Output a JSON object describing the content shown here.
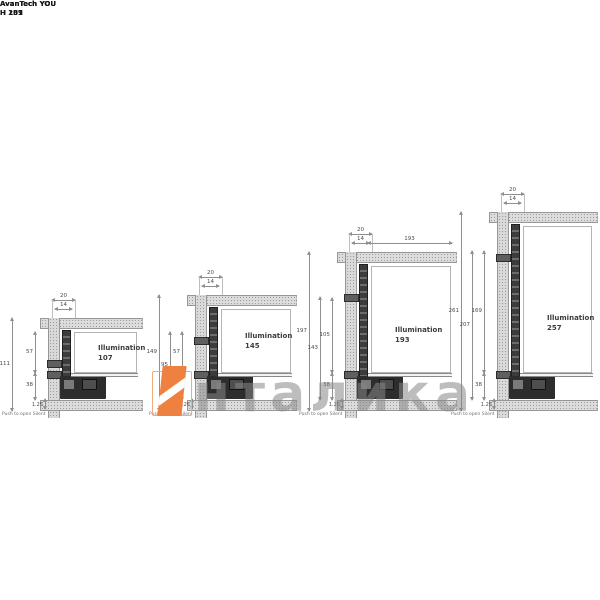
{
  "watermark": {
    "text": "нталика",
    "logo_color": "#ee8140",
    "outline_color": "#f3aa7c",
    "text_color": "#878787"
  },
  "drawings": [
    {
      "title_line1": "AvanTech YOU",
      "title_line2": "H 101",
      "illumination_label": "Illumination",
      "illumination_value": "107",
      "dim_width_outer": "20",
      "dim_width_inner": "14",
      "dim_total": "111",
      "dim_outer": "",
      "dim_upper": "57",
      "dim_lower": "38",
      "dim_top_right": "",
      "bottom_gap": "1.25",
      "note": "Push to open Silent"
    },
    {
      "title_line1": "AvanTech YOU",
      "title_line2": "H 139",
      "illumination_label": "Illumination",
      "illumination_value": "145",
      "dim_width_outer": "20",
      "dim_width_inner": "14",
      "dim_total": "149",
      "dim_outer": "95",
      "dim_upper": "57",
      "dim_lower": "38",
      "dim_top_right": "",
      "bottom_gap": "1.25",
      "note": "Push to open Silent"
    },
    {
      "title_line1": "AvanTech YOU",
      "title_line2": "H 187",
      "illumination_label": "Illumination",
      "illumination_value": "193",
      "dim_width_outer": "20",
      "dim_width_inner": "14",
      "dim_total": "197",
      "dim_outer": "143",
      "dim_upper": "105",
      "dim_lower": "38",
      "dim_top_right": "193",
      "bottom_gap": "1.25",
      "note": "Push to open Silent"
    },
    {
      "title_line1": "AvanTech YOU",
      "title_line2": "H 251",
      "illumination_label": "Illumination",
      "illumination_value": "257",
      "dim_width_outer": "20",
      "dim_width_inner": "14",
      "dim_total": "261",
      "dim_outer": "207",
      "dim_upper": "169",
      "dim_lower": "38",
      "dim_top_right": "",
      "bottom_gap": "1.25",
      "note": "Push to open Silent"
    }
  ]
}
